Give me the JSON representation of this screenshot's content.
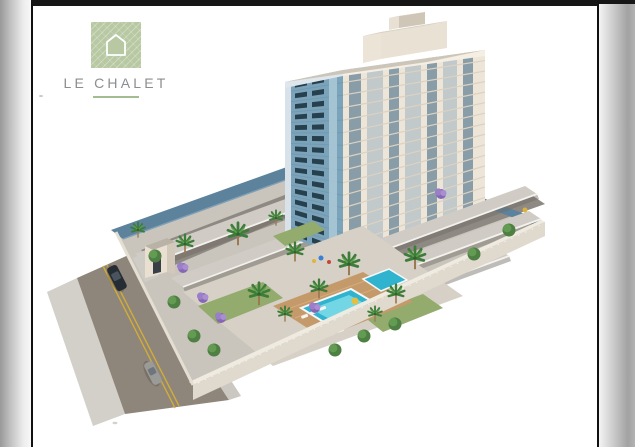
{
  "brand": {
    "name": "LE CHALET",
    "logo_green": "#b7c8a2",
    "text_color": "#8b8e90",
    "underline_color": "#a4bd90"
  },
  "frame": {
    "top_bar": "#161616",
    "border": "#101010",
    "page_white": "#ffffff"
  },
  "scene": {
    "alt": "Aerial 3D architectural rendering of the Le Chalet residential development: a 15-storey tower with cream and blue facades above a walled podium with covered parking rows, a landscaped pool courtyard with palm and jacaranda trees, an entrance gate, and a street with two cars",
    "tower": {
      "floors": 15,
      "facade_cream": "#ede5d8",
      "facade_blue": "#7ba3ba",
      "window_glass": "#26404e",
      "glass_strip": "#6f8b9c",
      "balcony_strip": "#9db3c0",
      "roof": "#ccc5b9",
      "rooftop_box": "#e9e1d3"
    },
    "parking": {
      "roof_gray": "#d0ccc5",
      "roof_blue": "#5d829c"
    },
    "pool": {
      "water": "#2fb3cf",
      "shallow": "#7edce9"
    },
    "ground": {
      "plot": "#cac5bc",
      "driveway": "#8f8983",
      "wall": "#e0d9cd",
      "deck": "#c59a6b",
      "lawn": "#93ab6c"
    },
    "road": {
      "asphalt": "#8e857b",
      "sidewalk": "#cbc7c1",
      "line_yellow": "#d2ac38",
      "cars": [
        {
          "label": "dark sedan",
          "color": "#262c33"
        },
        {
          "label": "silver sedan",
          "color": "#9a9a97"
        }
      ]
    },
    "landscape": {
      "palm_green": "#3e7c3a",
      "tree_green": "#4e7f43",
      "jacaranda": "#9b7ec8",
      "palms": [
        [
          105,
          224
        ],
        [
          152,
          238
        ],
        [
          205,
          228
        ],
        [
          243,
          212
        ],
        [
          262,
          246
        ],
        [
          226,
          288
        ],
        [
          252,
          308
        ],
        [
          286,
          283
        ],
        [
          316,
          258
        ],
        [
          342,
          308
        ],
        [
          363,
          288
        ],
        [
          382,
          252
        ]
      ],
      "trees": [
        [
          122,
          250
        ],
        [
          141,
          296
        ],
        [
          161,
          330
        ],
        [
          181,
          344
        ],
        [
          331,
          330
        ],
        [
          302,
          344
        ],
        [
          362,
          318
        ],
        [
          441,
          248
        ],
        [
          476,
          224
        ]
      ],
      "jacarandas": [
        [
          150,
          262
        ],
        [
          170,
          292
        ],
        [
          188,
          312
        ],
        [
          408,
          188
        ],
        [
          282,
          302
        ]
      ]
    }
  }
}
